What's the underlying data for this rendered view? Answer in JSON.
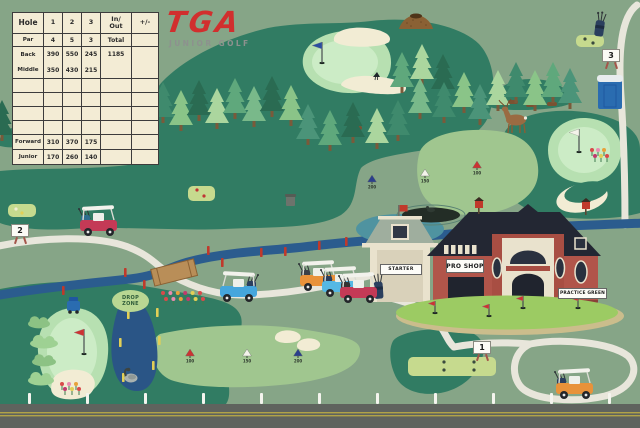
{
  "colors": {
    "background": "#86a587",
    "rough": "#317c63",
    "fairway_light": "#a0c68f",
    "green_mint": "#b7e0b1",
    "green_inner": "#ccecc6",
    "bunker": "#f2ecd4",
    "river": "#2b5c8e",
    "pond": "#2a5586",
    "teal_water": "#4f93a0",
    "path": "#e8e6db",
    "road": "#5f635e",
    "road_line": "#b1a348",
    "brick": "#b1554a",
    "roof_dark": "#232733",
    "trim_cream": "#e9e2cd",
    "logo_red": "#d12f2e",
    "practice_green": "#9ccb63"
  },
  "logo": {
    "title": "TGA",
    "subtitle": "JUNIOR GOLF"
  },
  "scorecard": {
    "headers": [
      "Hole",
      "1",
      "2",
      "3",
      "In/Out",
      "+/-"
    ],
    "col_widths": [
      31,
      19,
      19,
      19,
      31,
      27
    ],
    "rows": [
      {
        "label": "Par",
        "values": [
          "4",
          "5",
          "3",
          "Total",
          ""
        ],
        "h": 13
      },
      {
        "label": "Back",
        "values": [
          "390",
          "550",
          "245",
          "1185",
          ""
        ],
        "h": 16,
        "group": "top"
      },
      {
        "label": "Middle",
        "values": [
          "350",
          "430",
          "215",
          "",
          ""
        ],
        "h": 16,
        "group": "bottom"
      },
      {
        "label": "",
        "values": [
          "",
          "",
          "",
          "",
          ""
        ],
        "h": 14
      },
      {
        "label": "",
        "values": [
          "",
          "",
          "",
          "",
          ""
        ],
        "h": 14
      },
      {
        "label": "",
        "values": [
          "",
          "",
          "",
          "",
          ""
        ],
        "h": 14
      },
      {
        "label": "",
        "values": [
          "",
          "",
          "",
          "",
          ""
        ],
        "h": 14
      },
      {
        "label": "Forward",
        "values": [
          "310",
          "370",
          "175",
          "",
          ""
        ],
        "h": 15
      },
      {
        "label": "Junior",
        "values": [
          "170",
          "260",
          "140",
          "",
          ""
        ],
        "h": 15
      }
    ]
  },
  "signs": {
    "starter": "STARTER",
    "pro_shop": "PRO SHOP",
    "practice_green": "PRACTICE GREEN",
    "drop_zone_line1": "DROP",
    "drop_zone_line2": "ZONE"
  },
  "hole_signs": [
    {
      "number": "1",
      "x": 473,
      "y": 341
    },
    {
      "number": "2",
      "x": 11,
      "y": 224
    },
    {
      "number": "3",
      "x": 602,
      "y": 49
    }
  ],
  "yardage_markers": [
    {
      "label": "200",
      "flag": "#2b3f8c",
      "x": 372,
      "y": 176
    },
    {
      "label": "150",
      "flag": "#f4f3ea",
      "x": 425,
      "y": 170
    },
    {
      "label": "100",
      "flag": "#cc3333",
      "x": 477,
      "y": 162
    },
    {
      "label": "100",
      "flag": "#cc3333",
      "x": 190,
      "y": 350
    },
    {
      "label": "150",
      "flag": "#f4f3ea",
      "x": 247,
      "y": 350
    },
    {
      "label": "200",
      "flag": "#2b3f8c",
      "x": 298,
      "y": 350
    }
  ],
  "flags": [
    {
      "x": 322,
      "y": 42,
      "color": "#2b4ea0",
      "h": 21
    },
    {
      "x": 579,
      "y": 129,
      "color": "#f4f3ea",
      "h": 23
    },
    {
      "x": 84,
      "y": 329,
      "color": "#cc3333",
      "h": 25
    },
    {
      "x": 435,
      "y": 301,
      "color": "#cc3333",
      "h": 12
    },
    {
      "x": 489,
      "y": 304,
      "color": "#cc3333",
      "h": 12
    },
    {
      "x": 523,
      "y": 296,
      "color": "#cc3333",
      "h": 12
    },
    {
      "x": 578,
      "y": 296,
      "color": "#cc3333",
      "h": 12
    }
  ],
  "tees": [
    {
      "x": 8,
      "y": 204,
      "w": 28,
      "h": 13,
      "dots": [
        [
          16,
          209,
          "#f2ecd4"
        ],
        [
          22,
          213,
          "#e2cf56"
        ]
      ]
    },
    {
      "x": 188,
      "y": 186,
      "w": 27,
      "h": 15,
      "dots": [
        [
          197,
          190,
          "#c03434"
        ],
        [
          204,
          196,
          "#c03434"
        ]
      ]
    },
    {
      "x": 576,
      "y": 35,
      "w": 28,
      "h": 12,
      "dots": [
        [
          585,
          39,
          "#3a4a3e"
        ],
        [
          593,
          43,
          "#3a4a3e"
        ]
      ]
    },
    {
      "x": 408,
      "y": 357,
      "w": 88,
      "h": 19,
      "dots": [
        [
          444,
          362,
          "#3a4a3e"
        ],
        [
          444,
          370,
          "#3a4a3e"
        ],
        [
          474,
          362,
          "#3a4a3e"
        ],
        [
          474,
          370,
          "#3a4a3e"
        ]
      ]
    }
  ],
  "carts": [
    {
      "x": 80,
      "y": 206,
      "body": "#c43a56",
      "dir": 1,
      "bag": "#2f6e8e"
    },
    {
      "x": 220,
      "y": 272,
      "body": "#45a6dc",
      "dir": -1,
      "bag": "#2b3f5e"
    },
    {
      "x": 300,
      "y": 261,
      "body": "#e8923a",
      "dir": 1,
      "bag": "#3a4048"
    },
    {
      "x": 322,
      "y": 267,
      "body": "#56b8e4",
      "dir": 1,
      "bag": "#2b3f5e"
    },
    {
      "x": 340,
      "y": 273,
      "body": "#c43a56",
      "dir": 1,
      "bag": "#333333"
    },
    {
      "x": 556,
      "y": 369,
      "body": "#e8923a",
      "dir": 1,
      "bag": "#2b3f5e"
    }
  ],
  "tree_palette": [
    "#2a6b52",
    "#3f8a6d",
    "#5fa87c",
    "#8ac488",
    "#abd69e",
    "#4b9479",
    "#79b98a",
    "#2f7a5e"
  ],
  "trees": [
    [
      163,
      82,
      1
    ],
    [
      181,
      90,
      3
    ],
    [
      199,
      80,
      0
    ],
    [
      217,
      88,
      4
    ],
    [
      235,
      78,
      2
    ],
    [
      254,
      86,
      6
    ],
    [
      272,
      76,
      0
    ],
    [
      291,
      85,
      3
    ],
    [
      308,
      104,
      5
    ],
    [
      330,
      110,
      2
    ],
    [
      353,
      102,
      0
    ],
    [
      377,
      108,
      4
    ],
    [
      398,
      100,
      1
    ],
    [
      402,
      52,
      2
    ],
    [
      422,
      44,
      4
    ],
    [
      443,
      54,
      0
    ],
    [
      420,
      78,
      6
    ],
    [
      444,
      82,
      1
    ],
    [
      464,
      72,
      3
    ],
    [
      480,
      84,
      5
    ],
    [
      498,
      70,
      4
    ],
    [
      516,
      62,
      1
    ],
    [
      535,
      70,
      3
    ],
    [
      553,
      62,
      2
    ],
    [
      570,
      68,
      5
    ],
    [
      2,
      100,
      0
    ]
  ],
  "logs": [
    [
      508,
      100
    ],
    [
      526,
      103
    ],
    [
      547,
      102
    ],
    [
      352,
      126
    ],
    [
      300,
      124
    ]
  ],
  "red_stakes": [
    [
      62,
      286
    ],
    [
      124,
      268
    ],
    [
      143,
      280
    ],
    [
      207,
      246
    ],
    [
      221,
      258
    ],
    [
      260,
      248
    ],
    [
      284,
      247
    ],
    [
      318,
      241
    ],
    [
      345,
      237
    ]
  ],
  "yellow_stakes": [
    [
      127,
      310
    ],
    [
      156,
      308
    ],
    [
      119,
      338
    ],
    [
      158,
      336
    ],
    [
      152,
      361
    ],
    [
      122,
      373
    ]
  ],
  "road_posts": [
    28,
    86,
    144,
    202,
    260,
    318,
    376,
    434,
    492,
    550,
    608
  ],
  "flower_colors": [
    "#d84a4a",
    "#e88bb0",
    "#e8a23a",
    "#c03a6e",
    "#e2cf56",
    "#d84a4a"
  ],
  "flower_clusters": [
    {
      "x": 163,
      "y": 293,
      "cols": 6,
      "rows": 2,
      "dx": 7.4,
      "dy": 6
    },
    {
      "x": 592,
      "y": 150,
      "cols": 3,
      "rows": 2,
      "dx": 6,
      "dy": 6
    },
    {
      "x": 62,
      "y": 384,
      "cols": 3,
      "rows": 2,
      "dx": 7,
      "dy": 5
    }
  ],
  "bush_palette": [
    "#8cc284",
    "#9ed193"
  ],
  "bushes": [
    [
      28,
      318,
      22,
      9
    ],
    [
      30,
      337,
      28,
      10
    ],
    [
      32,
      356,
      24,
      9
    ],
    [
      28,
      374,
      26,
      10
    ]
  ],
  "icons": {
    "deer": {
      "x": 498,
      "y": 100
    },
    "bird": {
      "x": 373,
      "y": 72
    },
    "goose": {
      "x": 124,
      "y": 368
    },
    "porta_potty": {
      "x": 597,
      "y": 73
    },
    "mound": {
      "x": 399,
      "y": 11
    },
    "trash_bin": {
      "x": 285,
      "y": 194
    },
    "golf_bag_1": {
      "x": 598,
      "y": 14
    },
    "golf_bag_2": {
      "x": 374,
      "y": 276
    },
    "ball_washer": {
      "x": 67,
      "y": 297
    },
    "birdhouse_1": {
      "x": 475,
      "y": 200
    },
    "birdhouse_2": {
      "x": 582,
      "y": 201
    },
    "pond_duck": {
      "x": 427,
      "y": 206
    }
  }
}
